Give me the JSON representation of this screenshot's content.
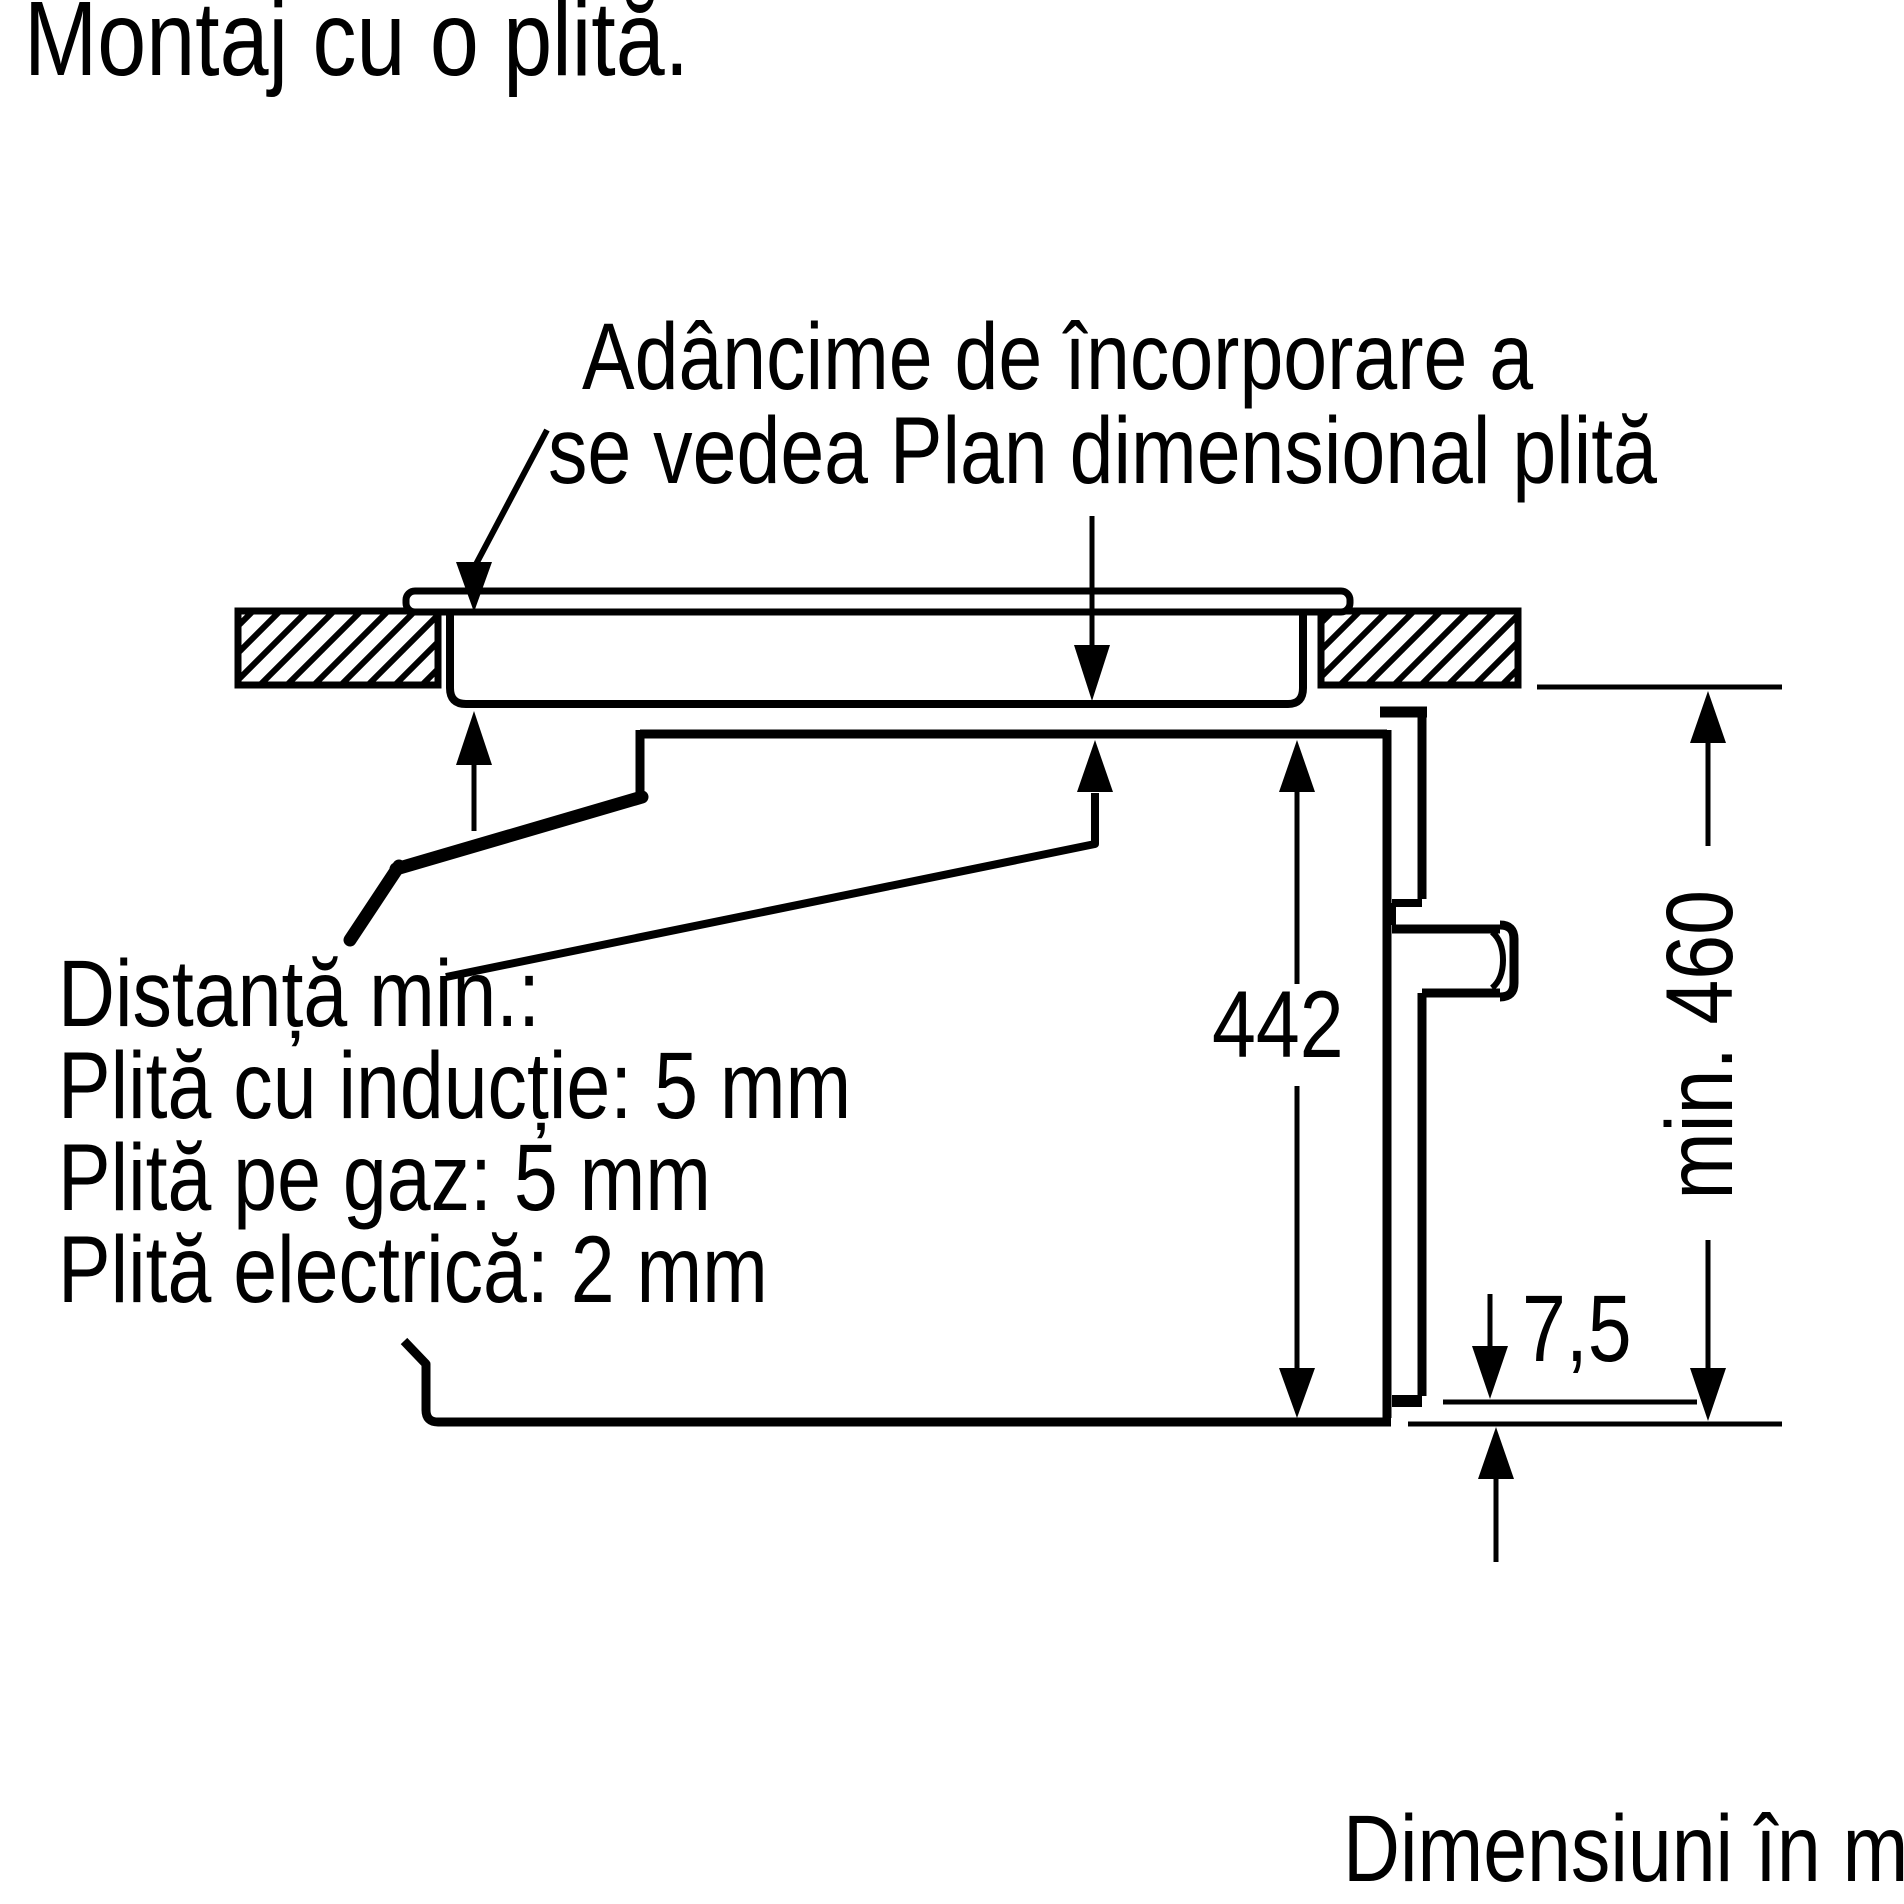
{
  "title": "Montaj cu o plită.",
  "annotations": {
    "embed_depth_line1": "Adâncime de încorporare a",
    "embed_depth_line2": "se vedea Plan dimensional plită",
    "min_distance_lines": [
      "Distanță min.:",
      "Plită cu inducție: 5 mm",
      "Plită pe gaz: 5 mm",
      "Plită electrică: 2 mm"
    ],
    "units_note": "Dimensiuni în mm"
  },
  "dimensions": {
    "oven_height_mm": "442",
    "niche_height_mm": "min. 460",
    "bottom_offset_mm": "7,5"
  },
  "icons": {
    "arrow_style": "filled-triangle-dimension-arrows",
    "hatch_style": "diagonal-section-hatch"
  },
  "colors": {
    "line": "#000000",
    "background": "#ffffff"
  }
}
